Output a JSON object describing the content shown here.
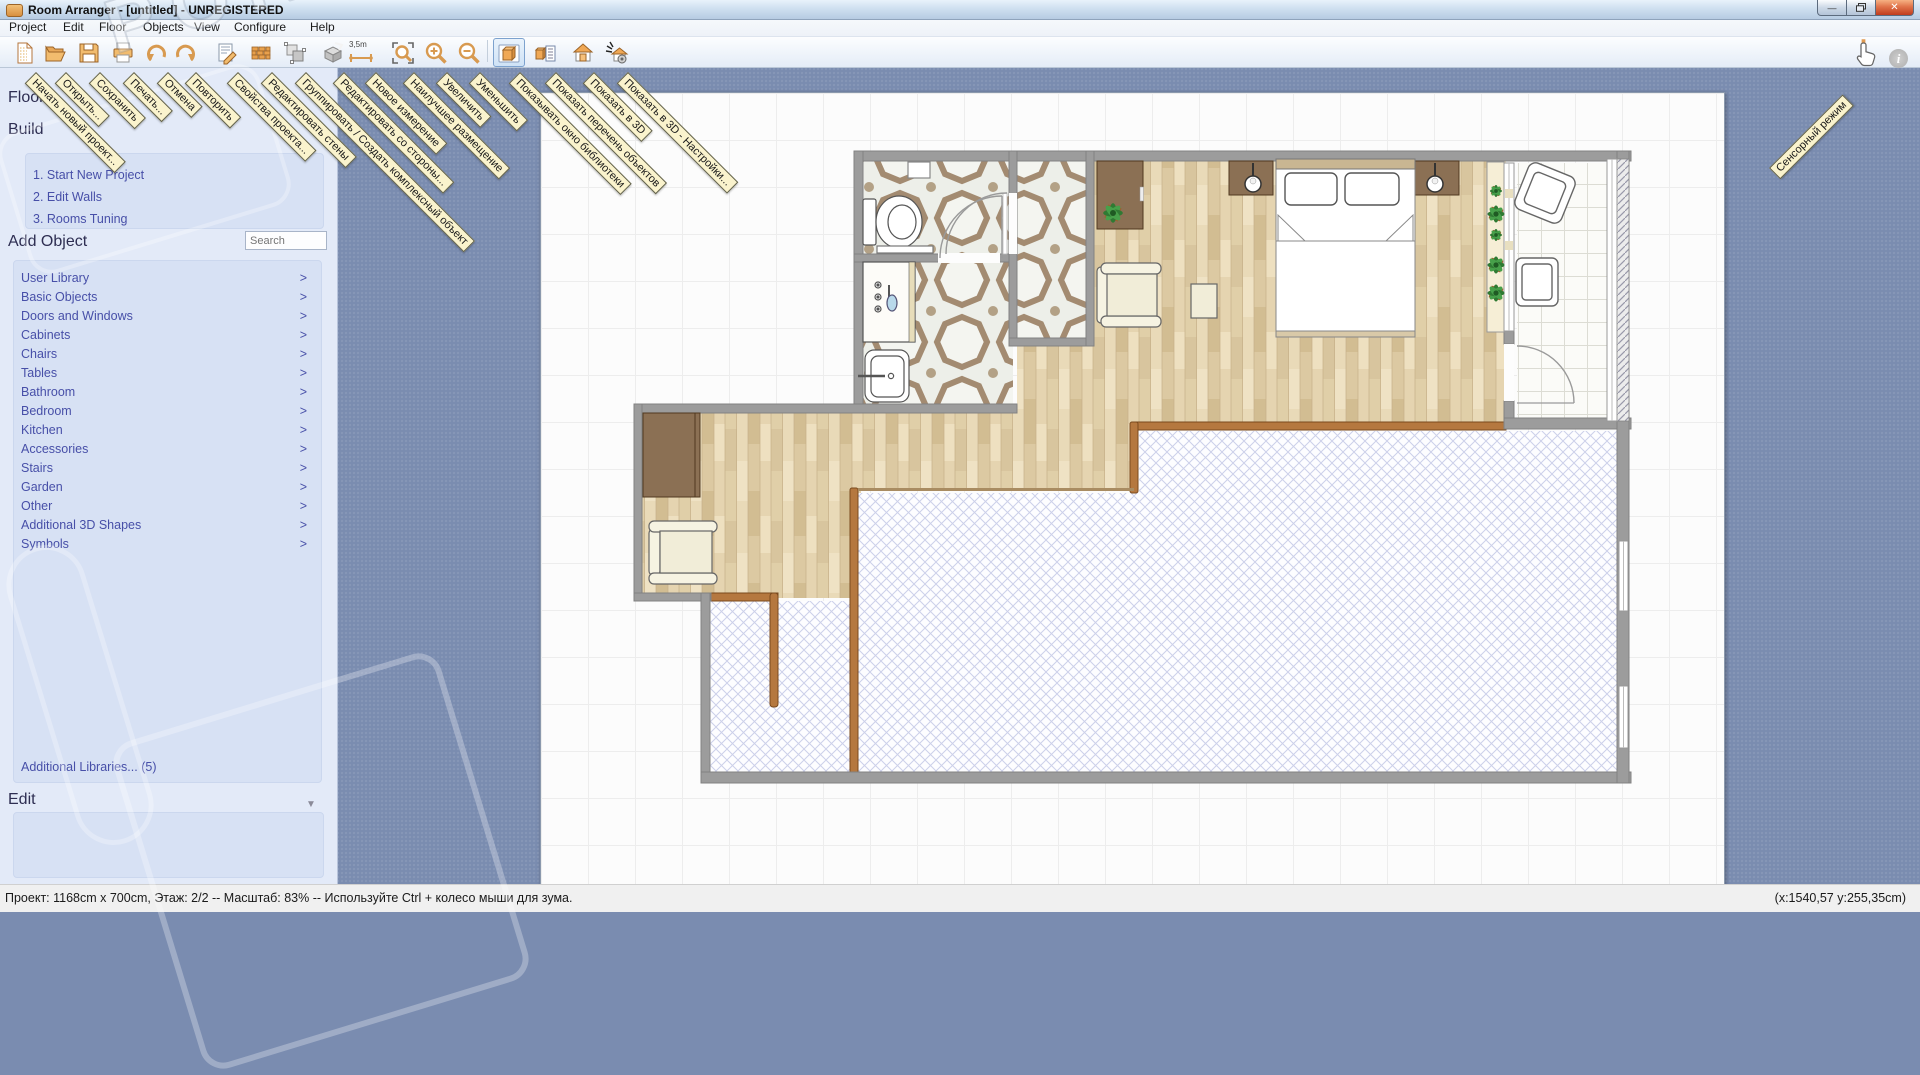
{
  "window": {
    "title": "Room Arranger - [untitled] - UNREGISTERED",
    "minimize_glyph": "—",
    "close_glyph": "✕"
  },
  "menu": {
    "items": [
      "Project",
      "Edit",
      "Floor",
      "Objects",
      "View",
      "Configure",
      "Help"
    ]
  },
  "toolbar": {
    "measure_label": "3,5m",
    "touch_tooltip": "Сенсорный режим",
    "buttons": [
      {
        "name": "new-project",
        "tooltip": "Начать новый проект..."
      },
      {
        "name": "open",
        "tooltip": "Открыть..."
      },
      {
        "name": "save",
        "tooltip": "Сохранить"
      },
      {
        "name": "print",
        "tooltip": "Печать..."
      },
      {
        "name": "undo",
        "tooltip": "Отмена"
      },
      {
        "name": "redo",
        "tooltip": "Повторить"
      },
      {
        "name": "project-properties",
        "tooltip": "Свойства проекта..."
      },
      {
        "name": "edit-walls",
        "tooltip": "Редактировать стены"
      },
      {
        "name": "group-create-complex-object",
        "tooltip": "Группировать / Создать комплексный объект"
      },
      {
        "name": "edit-from-side",
        "tooltip": "Редактировать со стороны..."
      },
      {
        "name": "new-measurement",
        "tooltip": "Новое измерение"
      },
      {
        "name": "best-fit",
        "tooltip": "Наилучшее размещение"
      },
      {
        "name": "zoom-in",
        "tooltip": "Увеличить"
      },
      {
        "name": "zoom-out",
        "tooltip": "Уменьшить"
      },
      {
        "name": "show-library-window",
        "tooltip": "Показывать окно библиотеки",
        "selected": true
      },
      {
        "name": "show-object-list",
        "tooltip": "Показать перечень объектов"
      },
      {
        "name": "show-3d",
        "tooltip": "Показать в 3D"
      },
      {
        "name": "show-3d-settings",
        "tooltip": "Показать в 3D - Настройки..."
      }
    ]
  },
  "sidebar": {
    "floor_header": "Floor",
    "build": {
      "header": "Build",
      "steps": [
        "1. Start New Project",
        "2. Edit Walls",
        "3. Rooms Tuning"
      ]
    },
    "add_object": {
      "header": "Add Object",
      "search_placeholder": "Search"
    },
    "chevron": ">",
    "categories": [
      "User Library",
      "Basic Objects",
      "Doors and Windows",
      "Cabinets",
      "Chairs",
      "Tables",
      "Bathroom",
      "Bedroom",
      "Kitchen",
      "Accessories",
      "Stairs",
      "Garden",
      "Other",
      "Additional 3D Shapes",
      "Symbols"
    ],
    "additional_libraries": "Additional Libraries... (5)",
    "edit": {
      "header": "Edit",
      "collapse_glyph": "▼"
    }
  },
  "statusbar": {
    "left": "Проект: 1168cm x 700cm, Этаж: 2/2 -- Масштаб: 83% -- Используйте Ctrl + колесо мыши для зума.",
    "right": "(x:1540,57 y:255,35cm)"
  },
  "watermark": "PORTAL",
  "colors": {
    "accent_orange": "#e09a50",
    "selection_blue": "#7da2ce",
    "link_blue": "#474fa8",
    "wall_gray": "#9c9c9c",
    "wall_brown": "#b5783f",
    "workspace_blue": "#7a8cb0",
    "tooltip_yellow": "#faf3cd"
  }
}
